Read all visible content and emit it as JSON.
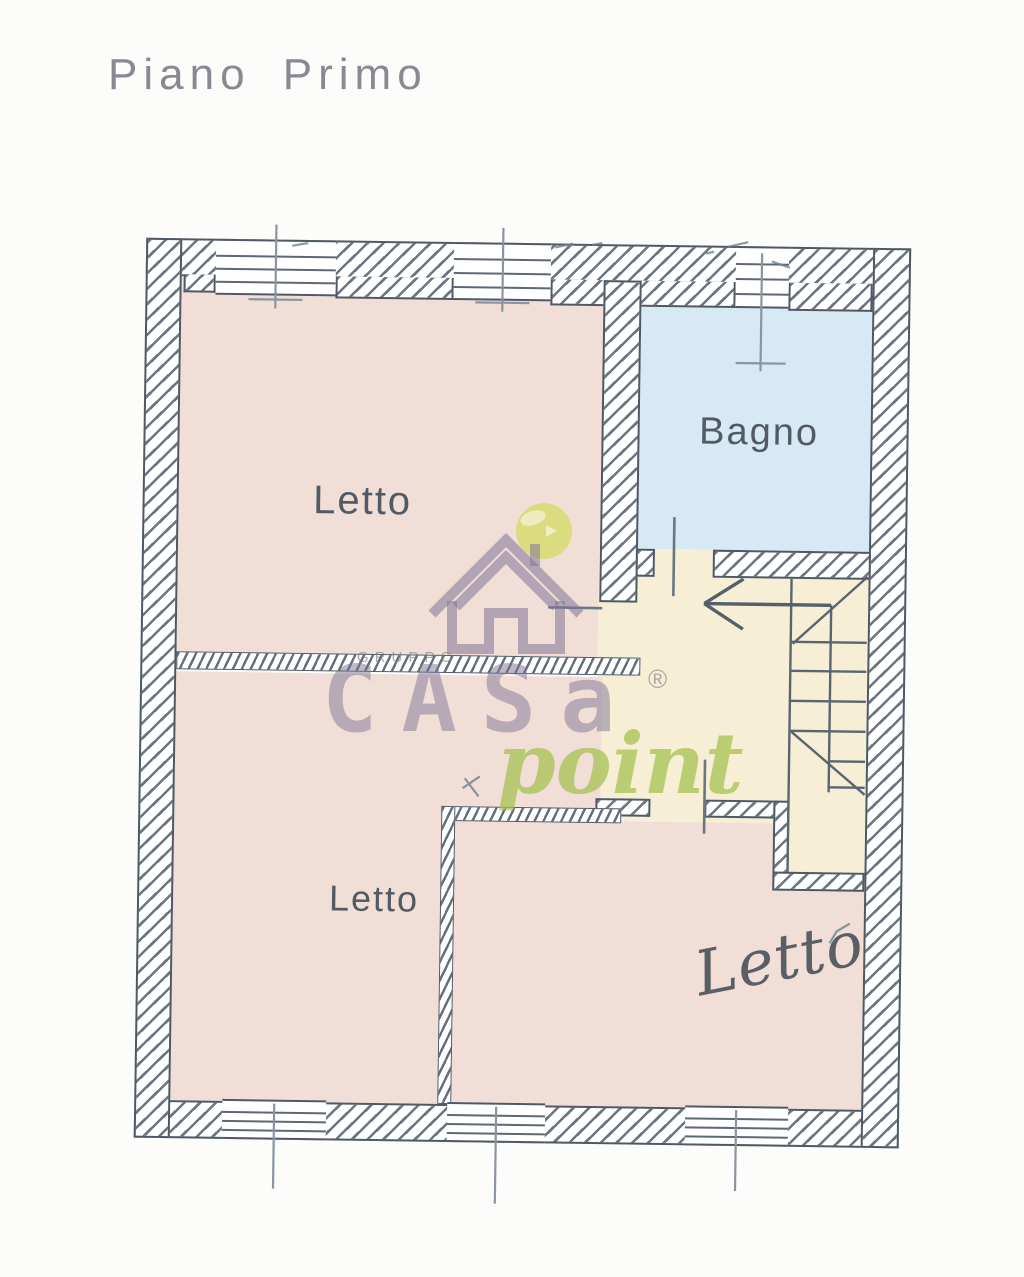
{
  "document": {
    "title": "Piano Primo"
  },
  "floor_plan": {
    "rooms": [
      {
        "id": "letto-top-left",
        "label": "Letto",
        "type": "bedroom",
        "fill": "#f1ded7"
      },
      {
        "id": "bagno",
        "label": "Bagno",
        "type": "bathroom",
        "fill": "#d6e9f4"
      },
      {
        "id": "letto-bottom-left",
        "label": "Letto",
        "type": "bedroom",
        "fill": "#f1ded7"
      },
      {
        "id": "letto-bottom-right",
        "label": "Letto",
        "type": "bedroom",
        "fill": "#f1ded7"
      },
      {
        "id": "stair-hall",
        "label": "",
        "type": "stairwell",
        "fill": "#f6efd5"
      }
    ],
    "features": [
      "stairs-with-direction-arrow",
      "windows",
      "doors"
    ],
    "colors": {
      "wall_line": "#4e5965",
      "hatch": "#525e6c",
      "pencil_line": "#7f8a96",
      "bedroom_fill": "#f1ded7",
      "bathroom_fill": "#d6e9f4",
      "stair_fill": "#f6efd5",
      "title_text": "#878a92",
      "label_text": "#525a64"
    }
  },
  "watermark": {
    "brand_group": "GRUPPO",
    "brand_main": "CASa",
    "brand_script": "point",
    "registered_mark": "®",
    "colors": {
      "logo_purple": "#807598",
      "logo_green_circle": "#d6da6a",
      "logo_green_script": "#a3bf4c",
      "gruppo_gray": "#7d7d82"
    }
  }
}
